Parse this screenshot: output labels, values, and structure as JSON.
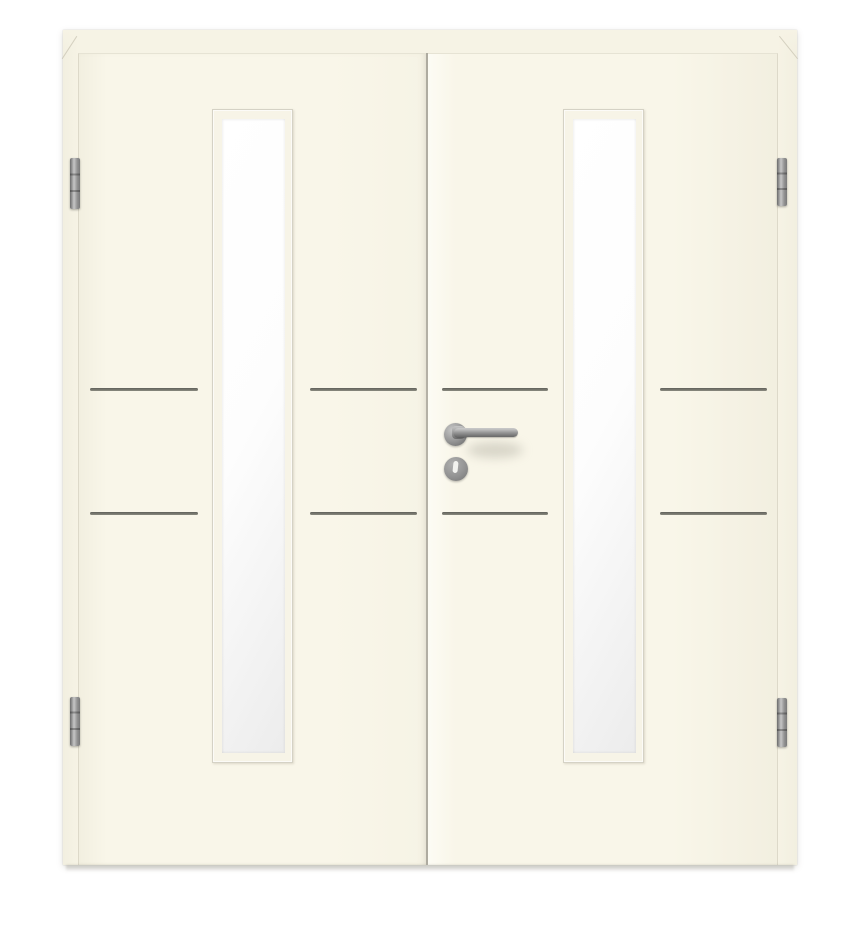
{
  "scene": {
    "subject": "Cream-white double interior door with two narrow vertical glass lites, four horizontal groove lines, stainless-steel lever handle with key rosette, and four hinges",
    "background_color": "#ffffff"
  },
  "colors": {
    "frame": "#f6f3e5",
    "leaf": "#f9f6e9",
    "leaf_bright": "#fdfcf5",
    "leaf_shade": "#f2efe0",
    "edge_line": "#ddd9c9",
    "top_line": "#e6e3d4",
    "gap_line": "#aeaba0",
    "lite_frame": "#f7f4e7",
    "lite_frame_line": "#d5d2c5",
    "glass_light": "#ffffff",
    "glass_dark": "#ececec",
    "groove_dark": "#60605a",
    "groove_light": "#8a8a7f",
    "metal_dark": "#6b6b6b",
    "metal_mid": "#939393",
    "metal_light": "#c6c6c6",
    "keyhole": "#f2f2ef"
  },
  "hardware": {
    "hinge_count": 4,
    "glass_lite_count": 2,
    "groove_rows_per_leaf": 2
  }
}
